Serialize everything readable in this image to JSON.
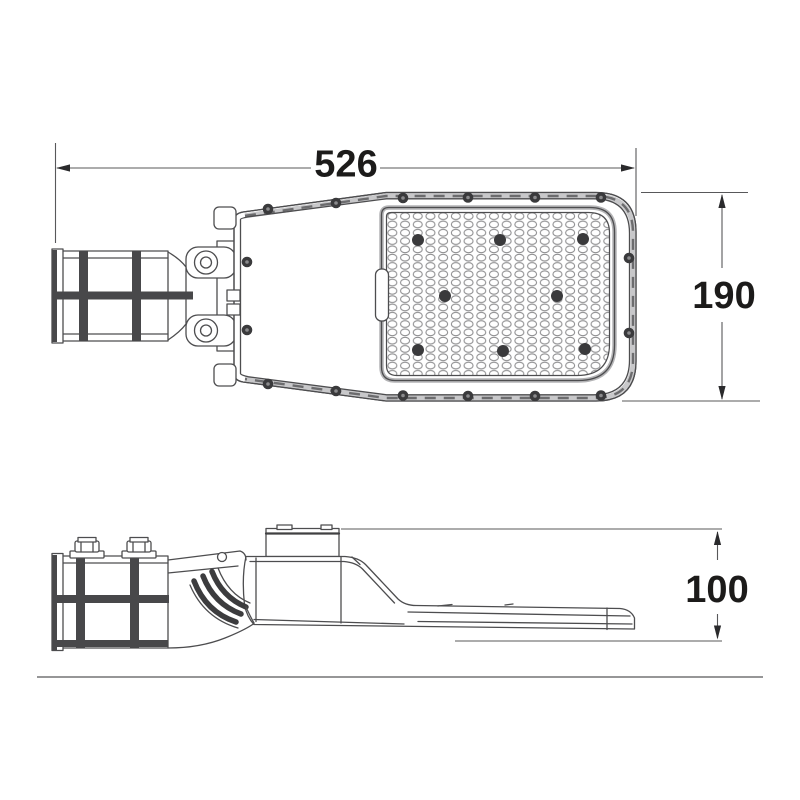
{
  "drawing": {
    "dimension_labels": {
      "length": "526",
      "width": "190",
      "height": "100"
    },
    "colors": {
      "background": "#ffffff",
      "line": "#4d4d4f",
      "dark_detail": "#3a3a3c",
      "dimension_line": "#58585a",
      "label_text": "#1c1b1a"
    }
  }
}
